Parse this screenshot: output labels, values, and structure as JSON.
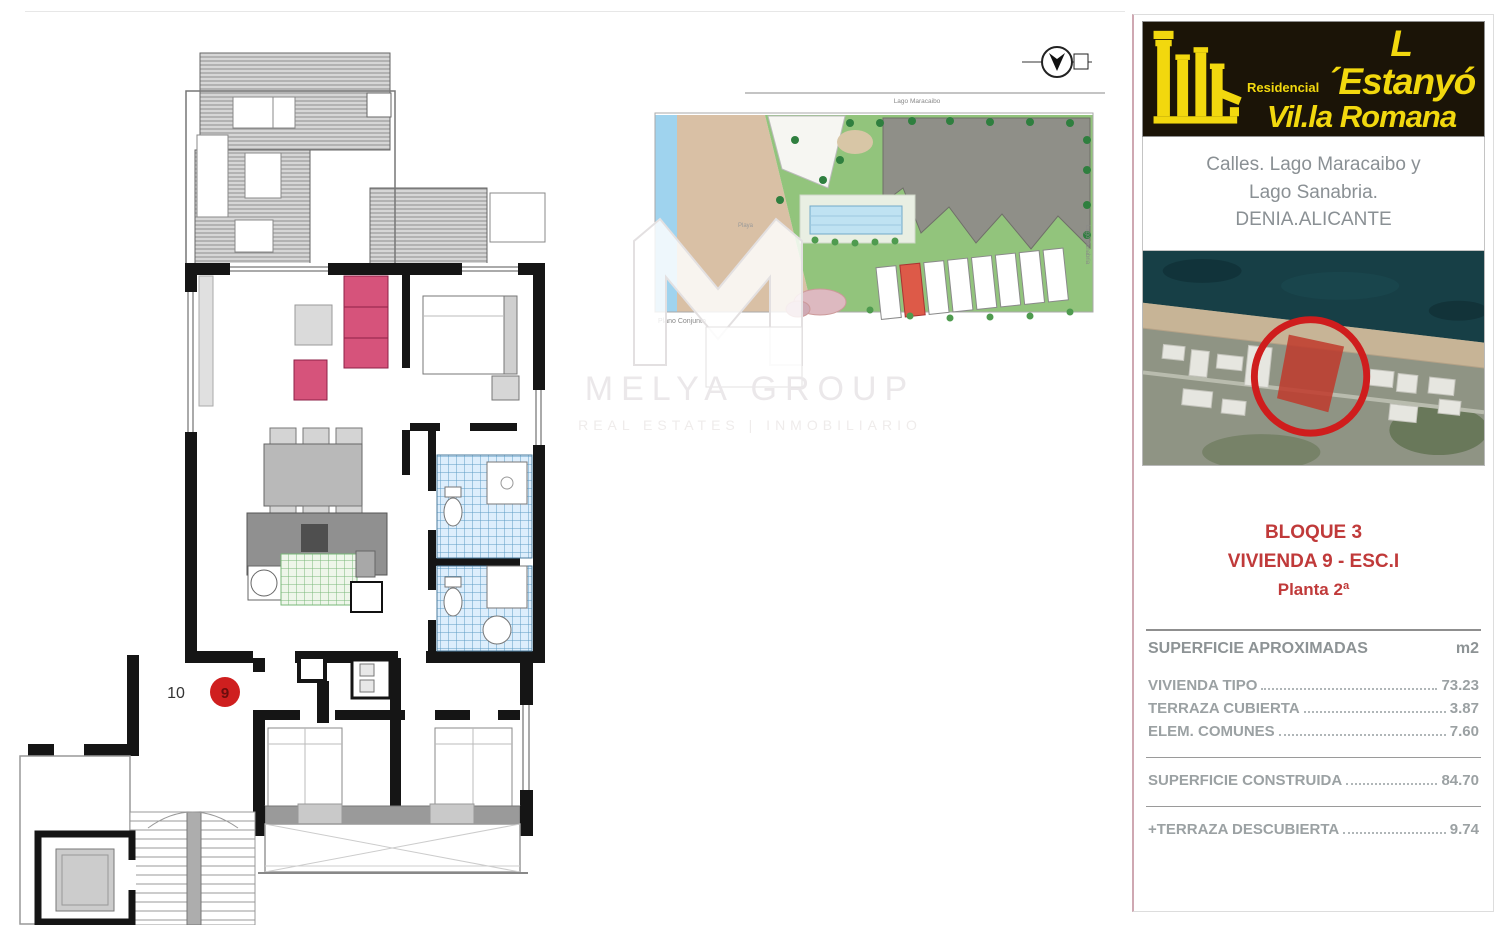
{
  "floor_plan": {
    "unit_label_10": "10",
    "unit_marker_9": "9"
  },
  "site_plan": {
    "street_top": "Lago Maracaibo",
    "street_right": "Lago Sanabria",
    "beach_label": "Playa",
    "caption": "Plano Conjunto"
  },
  "watermark": {
    "title": "MELYA GROUP",
    "subtitle": "REAL ESTATES | INMOBILIARIO"
  },
  "panel": {
    "brand": {
      "pre": "Residencial",
      "line1": "L´Estanyó",
      "line2": "Vil.la Romana"
    },
    "address": {
      "line1": "Calles. Lago Maracaibo y",
      "line2": "Lago Sanabria.",
      "line3": "DENIA.ALICANTE"
    },
    "unit": {
      "line1": "BLOQUE 3",
      "line2": "VIVIENDA 9 - ESC.I",
      "line3": "Planta 2ª"
    },
    "table": {
      "header": "SUPERFICIE APROXIMADAS",
      "unit_header": "m2",
      "rows": [
        {
          "label": "VIVIENDA TIPO",
          "value": "73.23"
        },
        {
          "label": "TERRAZA CUBIERTA",
          "value": "3.87"
        },
        {
          "label": "ELEM. COMUNES",
          "value": "7.60"
        }
      ],
      "total": {
        "label": "SUPERFICIE CONSTRUIDA",
        "value": "84.70"
      },
      "extra": {
        "label": "+TERRAZA DESCUBIERTA",
        "value": "9.74"
      }
    }
  },
  "colors": {
    "accent_red": "#c03a3a",
    "marker_red": "#cf1f1f",
    "logo_yellow": "#f2d80e",
    "logo_bg": "#1b1407",
    "sofa_pink": "#d6537b",
    "tile_blue": "#5d9cc4",
    "rug_green": "#79b879",
    "table_text_gray": "#9ba1a3"
  }
}
